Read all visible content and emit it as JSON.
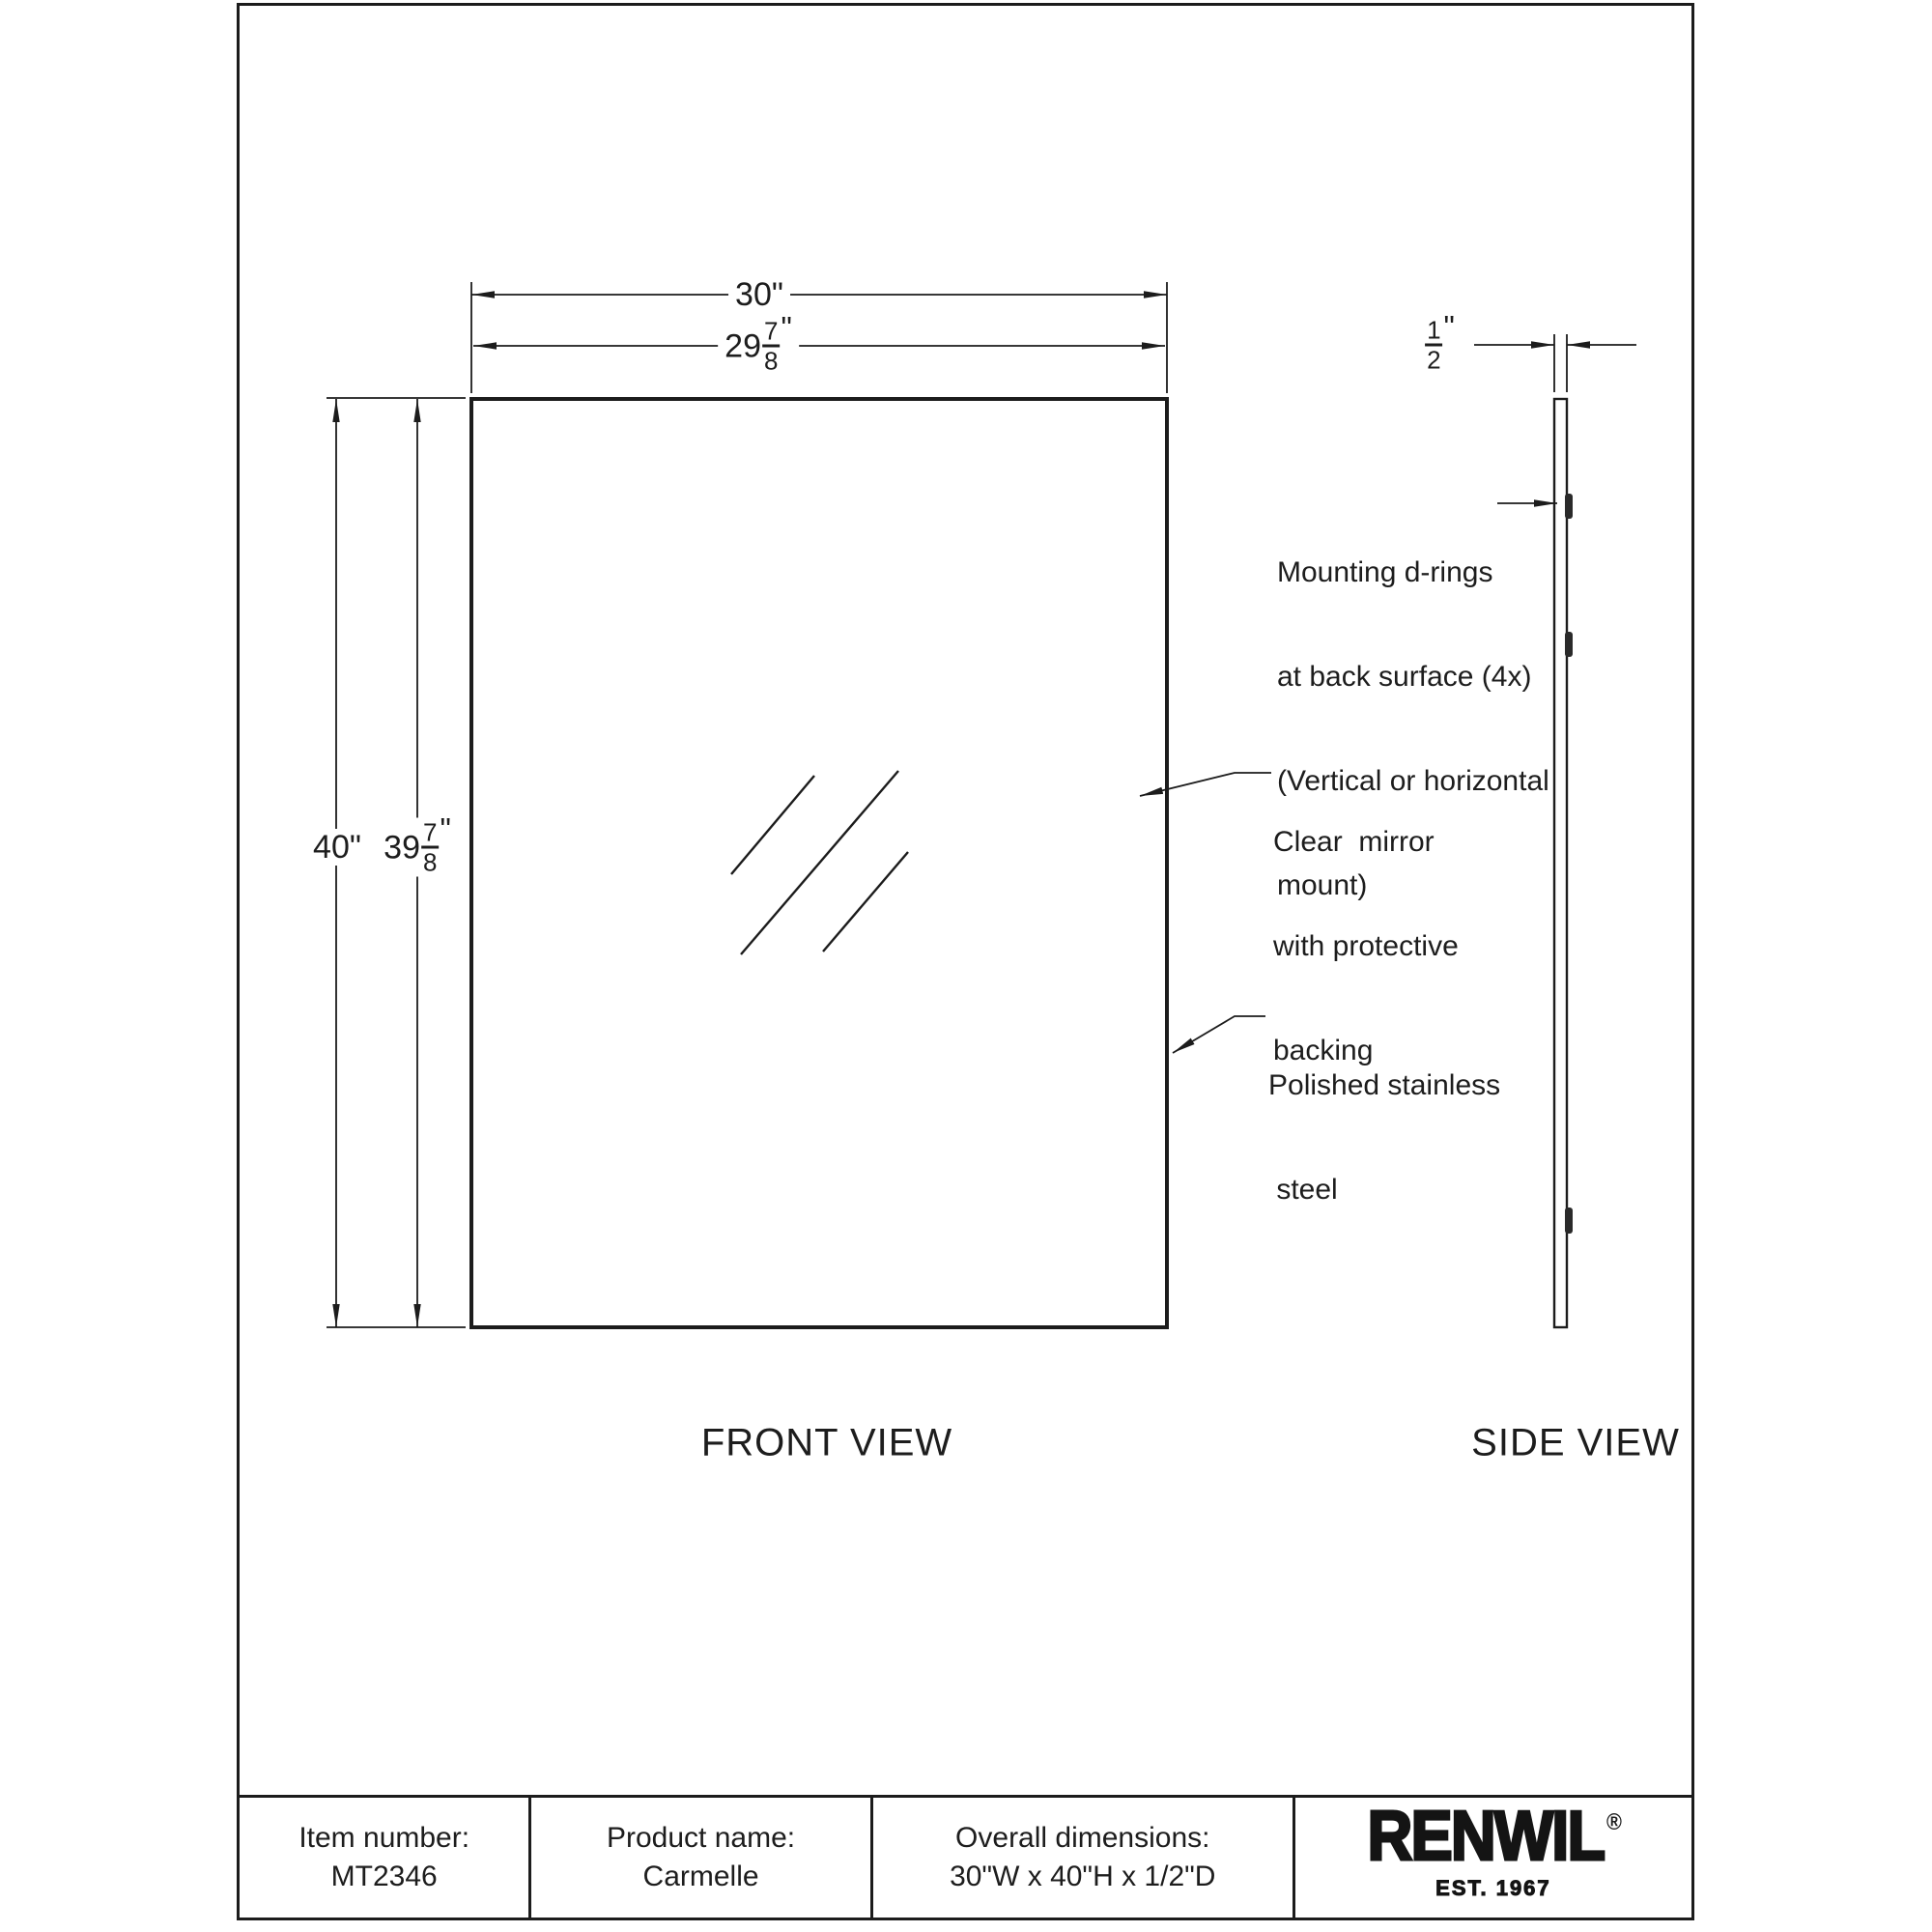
{
  "colors": {
    "ink": "#1c1c1c",
    "paper": "#ffffff"
  },
  "views": {
    "front_label": "FRONT VIEW",
    "side_label": "SIDE VIEW"
  },
  "dimensions": {
    "width_overall": {
      "value": "30",
      "unit": "\""
    },
    "width_glass": {
      "whole": "29",
      "num": "7",
      "den": "8",
      "unit": "\""
    },
    "height_overall": {
      "value": "40",
      "unit": "\""
    },
    "height_glass": {
      "whole": "39",
      "num": "7",
      "den": "8",
      "unit": "\""
    },
    "depth": {
      "num": "1",
      "den": "2",
      "unit": "\""
    }
  },
  "annotations": {
    "mounting": {
      "line1": "Mounting d-rings",
      "line2": "at back surface (4x)",
      "line3": "(Vertical or horizontal",
      "line4": "mount)"
    },
    "mirror": {
      "line1": "Clear  mirror",
      "line2": "with protective",
      "line3": "backing"
    },
    "frame": {
      "line1": "Polished stainless",
      "line2": " steel"
    }
  },
  "title_block": {
    "item": {
      "label": "Item number:",
      "value": "MT2346"
    },
    "product": {
      "label": "Product name:",
      "value": "Carmelle"
    },
    "overall": {
      "label": "Overall dimensions:",
      "value": "30\"W x 40\"H x 1/2\"D"
    },
    "brand": {
      "name": "RENWIL",
      "registered": "®",
      "established": "EST. 1967"
    }
  }
}
